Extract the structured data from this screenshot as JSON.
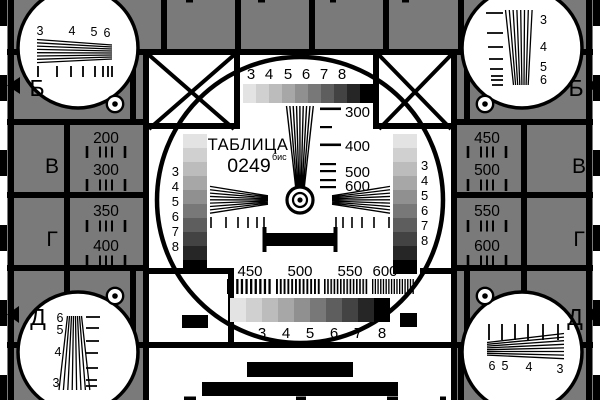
{
  "card": {
    "title": "ТАБЛИЦА",
    "number": "0249",
    "suffix": "бис"
  },
  "colors": {
    "background": "#7a7a7a",
    "line": "#000000",
    "white": "#ffffff",
    "letter": "#222222",
    "grayscale": [
      "#e3e3e3",
      "#d0d0d0",
      "#bcbcbc",
      "#a7a7a7",
      "#909090",
      "#787878",
      "#5e5e5e",
      "#434343",
      "#262626",
      "#000000"
    ]
  },
  "center": {
    "top_scale": [
      "3",
      "4",
      "5",
      "6",
      "7",
      "8"
    ],
    "bottom_scale": [
      "3",
      "4",
      "5",
      "6",
      "7",
      "8"
    ],
    "left_scale": [
      "3",
      "4",
      "5",
      "6",
      "7",
      "8"
    ],
    "right_scale": [
      "3",
      "4",
      "5",
      "6",
      "7",
      "8"
    ],
    "wedge_labels": [
      "300",
      "400",
      "500",
      "600"
    ],
    "burst_labels": [
      "450",
      "500",
      "550",
      "600"
    ]
  },
  "panels": {
    "left": [
      "200",
      "300",
      "350",
      "400"
    ],
    "right": [
      "450",
      "500",
      "550",
      "600"
    ]
  },
  "edge_markers": {
    "left": [
      "Б",
      "В",
      "Г",
      "Д"
    ],
    "right": [
      "Б",
      "В",
      "Г",
      "Д"
    ]
  },
  "corners": {
    "top_left": [
      "3",
      "4",
      "5",
      "6"
    ],
    "top_right": [
      "3",
      "4",
      "5",
      "6"
    ],
    "bottom_left": [
      "6",
      "5",
      "4",
      "3"
    ],
    "bottom_right": [
      "6",
      "5",
      "4",
      "3"
    ]
  }
}
